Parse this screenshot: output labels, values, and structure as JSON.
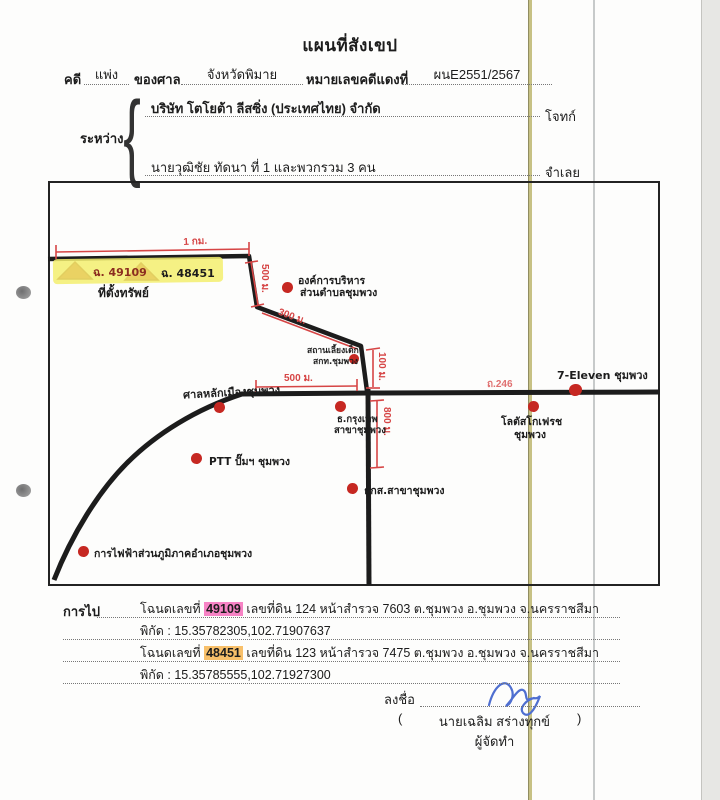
{
  "doc": {
    "title": "แผนที่สังเขป",
    "form": {
      "case_label": "คดี",
      "case_type": "แพ่ง",
      "court_label": "ของศาล",
      "court_name": "จังหวัดพิมาย",
      "case_no_label": "หมายเลขคดีแดงที่",
      "case_no": "ผนE2551/2567",
      "between": "ระหว่าง",
      "brace": "{",
      "plaintiff": "บริษัท โตโยต้า ลีสซิ่ง (ประเทศไทย) จำกัด",
      "plaintiff_role": "โจทก์",
      "defendant": "นายวุฒิชัย ทัดนา ที่ 1 และพวกรวม 3 คน",
      "defendant_role": "จำเลย"
    }
  },
  "map": {
    "marker1": "ฉ. 49109",
    "marker2": "ฉ. 48451",
    "property_caption": "ที่ตั้งทรัพย์",
    "dist_1km": "1 กม.",
    "dist_500a": "500 ม.",
    "dist_300": "300 ม.",
    "dist_100": "100 ม.",
    "dist_500b": "500 ม.",
    "dist_800": "800 ม.",
    "road_no": "ถ.246",
    "landmarks": {
      "sao1": "องค์การบริหาร",
      "sao2": "ส่วนตำบลชุมพวง",
      "daycare1": "สถานเลี้ยงเด็ก",
      "daycare2": "สกท.ชุมพวง",
      "pillar": "ศาลหลักเมืองชุมพวง",
      "bbl1": "ธ.กรุงเทพ",
      "bbl2": "สาขาชุมพวง",
      "seven": "7-Eleven ชุมพวง",
      "lotus1": "โลตัสโกเฟรช",
      "lotus2": "ชุมพวง",
      "ptt": "PTT ปั๊มฯ ชุมพวง",
      "baac": "ธกส.สาขาชุมพวง",
      "pea": "การไฟฟ้าส่วนภูมิภาคอำเภอชุมพวง"
    }
  },
  "directions": {
    "label": "การไป",
    "deed1_prefix": "โฉนดเลขที่",
    "deed1_no": "49109",
    "deed1_rest": "เลขที่ดิน 124  หน้าสำรวจ 7603  ต.ชุมพวง อ.ชุมพวง จ.นครราชสีมา",
    "coord1": "พิกัด : 15.35782305,102.71907637",
    "deed2_prefix": "โฉนดเลขที่",
    "deed2_no": "48451",
    "deed2_rest": "เลขที่ดิน 123 หน้าสำรวจ 7475 ต.ชุมพวง อ.ชุมพวง จ.นครราชสีมา",
    "coord2": "พิกัด : 15.35785555,102.71927300"
  },
  "signature": {
    "label": "ลงชื่อ",
    "paren_open": "(",
    "name": "นายเฉลิม สร่างทุกข์",
    "paren_close": ")",
    "role": "ผู้จัดทำ"
  },
  "colors": {
    "road": "#1c1c1c",
    "annotation_red": "#d64545",
    "marker_red": "#c62822",
    "highlight_yellow": "#f3ee6e",
    "highlight_pink": "#f783c5",
    "highlight_orange": "#f8c06a",
    "signature_blue": "#4f6fd0"
  }
}
